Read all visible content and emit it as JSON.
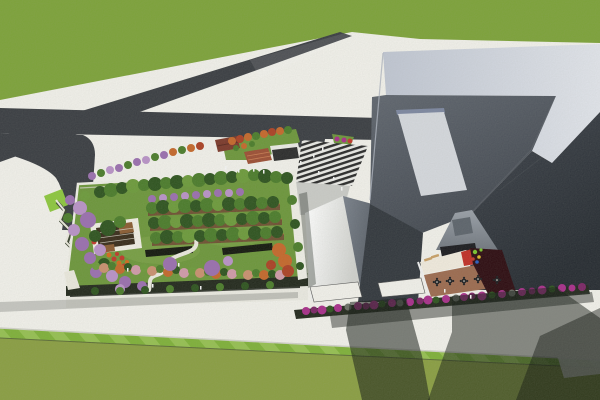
{
  "scene": {
    "type": "3d-architectural-aerial-render",
    "description": "Aerial 3D render: low building with rooftop garden at left, large angular grey building with inner courtyard at right, crossing asphalt roads over white pavement, green lawns top and bottom",
    "palette": {
      "grassTop": "#7da23a",
      "lawnMain": "#8a9e43",
      "lawnA": "#7fb03a",
      "lawnB": "#95bf52",
      "lawnEdge": "#5c6c38",
      "curb": "#d0d0c8",
      "pave": "#f0efe9",
      "road": "#3b3e43",
      "roadGlare": "rgba(255,255,255,0.10)",
      "lime": "#8dc63f",
      "parapetL": "#bfc5d1",
      "parapetR": "#e0e3e9",
      "roofLa": "#60666f",
      "roofLb": "#42474f",
      "roofRa": "#40454d",
      "roofRb": "#272c32",
      "facadeDark": "#33383e",
      "edgeHi": "#aeb4bf",
      "skylight": "#d4d7dc",
      "coping": "#7d87a0",
      "innerWallA": "#9aa0a8",
      "innerWallB": "#70767e",
      "ctVent": "#5d646c",
      "ctShade": "#1c1c20",
      "ctWhite": "#efe9dc",
      "ctBrown": "#9c6b50",
      "ctRed": "#c03028",
      "ctMaroon": "#2e0d12",
      "lounger": "#c8a068",
      "tableDark": "#1f2023",
      "brightA": "#ffffff",
      "brightB": "#cfd0cc",
      "grayWallA": "#7a818b",
      "grayWallB": "#4e545c",
      "ramp": "#c9cac6",
      "stripeDark": "#2a2a2a",
      "stripeLight": "#e8e8e4",
      "canopyWhite": "#f0efe9",
      "canopyEdge": "#555555",
      "kioskRed": "#7c3a2c",
      "kioskRidge": "#5c2a20",
      "shelterDark": "#2d2d2d",
      "shelterFascia": "#e9e9e3",
      "stepsTerra": "#9c4f35",
      "stepsLine": "#c77b52",
      "gardenLawn": "#6d963c",
      "gardenLawnLight": "#7ea44a",
      "facadeWhite": "#e9e8e0",
      "windowSlit": "#383c34",
      "hedge": "#242a1e",
      "hedgeDark": "#15190f",
      "planter": "#6f5233",
      "planterEdge": "#b5763c",
      "pergFrame": "#efece2",
      "pergDeck": "#3a2d1c",
      "pergWood": "#8a5c33",
      "path": "#e9e7dc",
      "pathWall": "#39422f",
      "gardenParapet": "#edece4",
      "tG": "#4c7c2c",
      "tGd": "#2f5420",
      "tGl": "#6d9a3c",
      "tO": "#c4682c",
      "tR": "#ab4226",
      "tP": "#9a6fae",
      "tPl": "#b892c6",
      "tPk": "#cf9aa8",
      "tS": "#c89070",
      "fR": "#c0392b",
      "fO": "#d2691e",
      "fM": "#a8308a",
      "fMd": "#7c2766",
      "fGr": "#6b6f66",
      "people": "#f4f4f4",
      "shLight": "rgba(40,45,40,0.22)",
      "shMid": "rgba(22,27,22,0.50)",
      "shCol": "rgba(22,27,22,0.55)",
      "shDeep": "rgba(14,18,14,0.45)",
      "shWalk": "rgba(45,50,45,0.50)",
      "shSliver": "rgba(25,35,25,0.35)"
    },
    "plaza_trees": [
      [
        92,
        176,
        4,
        "tP"
      ],
      [
        101,
        173,
        4,
        "tG"
      ],
      [
        110,
        170,
        4,
        "tPl"
      ],
      [
        119,
        168,
        4,
        "tP"
      ],
      [
        128,
        165,
        4,
        "tG"
      ],
      [
        137,
        162,
        4,
        "tP"
      ],
      [
        146,
        160,
        4,
        "tPl"
      ],
      [
        155,
        157,
        4,
        "tG"
      ],
      [
        164,
        155,
        4,
        "tP"
      ],
      [
        173,
        152,
        4,
        "tO"
      ],
      [
        182,
        150,
        4,
        "tG"
      ],
      [
        191,
        148,
        4,
        "tO"
      ],
      [
        200,
        146,
        4,
        "tR"
      ],
      [
        232,
        141,
        4,
        "tO"
      ],
      [
        240,
        139,
        4,
        "tR"
      ],
      [
        248,
        137,
        4,
        "tO"
      ],
      [
        256,
        136,
        4,
        "tG"
      ],
      [
        264,
        134,
        4,
        "tO"
      ],
      [
        272,
        132,
        4,
        "tR"
      ],
      [
        280,
        131,
        4,
        "tO"
      ],
      [
        288,
        130,
        4,
        "tG"
      ],
      [
        236,
        148,
        3,
        "tG"
      ],
      [
        244,
        146,
        3,
        "tO"
      ],
      [
        252,
        144,
        3,
        "tG"
      ],
      [
        337,
        139,
        2.5,
        "fM"
      ],
      [
        344,
        140,
        2.5,
        "fM"
      ],
      [
        350,
        141,
        2.5,
        "fR"
      ]
    ],
    "garden_trees": [
      [
        100,
        192,
        6,
        "tGd"
      ],
      [
        111,
        190,
        7,
        "tG"
      ],
      [
        122,
        188,
        6,
        "tGd"
      ],
      [
        133,
        186,
        7,
        "tGl"
      ],
      [
        144,
        185,
        6,
        "tG"
      ],
      [
        155,
        184,
        7,
        "tGd"
      ],
      [
        166,
        183,
        6,
        "tG"
      ],
      [
        177,
        182,
        7,
        "tGd"
      ],
      [
        188,
        181,
        6,
        "tGl"
      ],
      [
        199,
        180,
        7,
        "tG"
      ],
      [
        210,
        179,
        6,
        "tGd"
      ],
      [
        221,
        178,
        7,
        "tG"
      ],
      [
        232,
        177,
        6,
        "tGd"
      ],
      [
        243,
        176,
        7,
        "tGl"
      ],
      [
        254,
        175,
        6,
        "tG"
      ],
      [
        265,
        176,
        7,
        "tGd"
      ],
      [
        276,
        177,
        6,
        "tG"
      ],
      [
        287,
        178,
        6,
        "tGd"
      ],
      [
        152,
        199,
        4,
        "tP"
      ],
      [
        163,
        198,
        4,
        "tPl"
      ],
      [
        174,
        197,
        4,
        "tP"
      ],
      [
        185,
        196,
        4,
        "tPl"
      ],
      [
        196,
        195,
        4,
        "tP"
      ],
      [
        207,
        194,
        4,
        "tPl"
      ],
      [
        218,
        193,
        4,
        "tP"
      ],
      [
        229,
        193,
        4,
        "tPl"
      ],
      [
        240,
        192,
        4,
        "tP"
      ],
      [
        70,
        200,
        5,
        "tP"
      ],
      [
        80,
        208,
        7,
        "tPl"
      ],
      [
        68,
        218,
        5,
        "tG"
      ],
      [
        88,
        220,
        8,
        "tP"
      ],
      [
        74,
        230,
        6,
        "tPl"
      ],
      [
        95,
        236,
        6,
        "tGd"
      ],
      [
        82,
        244,
        7,
        "tP"
      ],
      [
        100,
        250,
        6,
        "tPl"
      ],
      [
        90,
        258,
        6,
        "tP"
      ],
      [
        104,
        264,
        6,
        "tGd"
      ],
      [
        96,
        272,
        6,
        "tP"
      ],
      [
        112,
        276,
        6,
        "tPl"
      ],
      [
        125,
        282,
        6,
        "tP"
      ],
      [
        85,
        196,
        5,
        "tGl"
      ],
      [
        108,
        228,
        8,
        "tGd"
      ],
      [
        120,
        222,
        6,
        "tG"
      ],
      [
        152,
        208,
        6,
        "tG"
      ],
      [
        163,
        207,
        7,
        "tGd"
      ],
      [
        174,
        207,
        6,
        "tGl"
      ],
      [
        185,
        206,
        7,
        "tG"
      ],
      [
        196,
        206,
        6,
        "tGd"
      ],
      [
        207,
        205,
        7,
        "tG"
      ],
      [
        218,
        205,
        6,
        "tGl"
      ],
      [
        229,
        204,
        7,
        "tGd"
      ],
      [
        240,
        204,
        6,
        "tG"
      ],
      [
        251,
        203,
        7,
        "tGd"
      ],
      [
        262,
        203,
        6,
        "tG"
      ],
      [
        273,
        202,
        6,
        "tGd"
      ],
      [
        154,
        223,
        6,
        "tGd"
      ],
      [
        165,
        222,
        7,
        "tG"
      ],
      [
        176,
        222,
        6,
        "tGl"
      ],
      [
        187,
        221,
        7,
        "tGd"
      ],
      [
        198,
        221,
        6,
        "tG"
      ],
      [
        209,
        220,
        7,
        "tGd"
      ],
      [
        220,
        220,
        6,
        "tG"
      ],
      [
        231,
        219,
        7,
        "tGl"
      ],
      [
        242,
        219,
        6,
        "tGd"
      ],
      [
        253,
        218,
        7,
        "tG"
      ],
      [
        264,
        218,
        6,
        "tGd"
      ],
      [
        275,
        217,
        6,
        "tG"
      ],
      [
        156,
        238,
        6,
        "tG"
      ],
      [
        167,
        237,
        7,
        "tGd"
      ],
      [
        178,
        237,
        6,
        "tG"
      ],
      [
        189,
        236,
        7,
        "tGl"
      ],
      [
        200,
        236,
        6,
        "tGd"
      ],
      [
        211,
        235,
        7,
        "tG"
      ],
      [
        222,
        235,
        6,
        "tGd"
      ],
      [
        233,
        234,
        7,
        "tG"
      ],
      [
        244,
        234,
        6,
        "tGl"
      ],
      [
        255,
        233,
        7,
        "tGd"
      ],
      [
        266,
        233,
        6,
        "tG"
      ],
      [
        277,
        232,
        6,
        "tGd"
      ],
      [
        96,
        266,
        4,
        "tGl"
      ],
      [
        104,
        268,
        5,
        "tS"
      ],
      [
        112,
        266,
        4,
        "tG"
      ],
      [
        120,
        269,
        5,
        "tO"
      ],
      [
        128,
        267,
        4,
        "tGd"
      ],
      [
        136,
        270,
        5,
        "tPk"
      ],
      [
        144,
        268,
        4,
        "tGl"
      ],
      [
        152,
        271,
        5,
        "tS"
      ],
      [
        160,
        269,
        4,
        "tG"
      ],
      [
        168,
        272,
        5,
        "tO"
      ],
      [
        176,
        270,
        4,
        "tGd"
      ],
      [
        184,
        273,
        5,
        "tPk"
      ],
      [
        192,
        271,
        4,
        "tGl"
      ],
      [
        200,
        273,
        5,
        "tS"
      ],
      [
        208,
        272,
        4,
        "tG"
      ],
      [
        216,
        274,
        5,
        "tO"
      ],
      [
        224,
        272,
        4,
        "tGd"
      ],
      [
        232,
        274,
        5,
        "tPk"
      ],
      [
        240,
        273,
        4,
        "tGl"
      ],
      [
        248,
        275,
        5,
        "tS"
      ],
      [
        256,
        273,
        4,
        "tG"
      ],
      [
        264,
        275,
        5,
        "tO"
      ],
      [
        272,
        274,
        4,
        "tGd"
      ],
      [
        280,
        275,
        5,
        "tPk"
      ],
      [
        279,
        250,
        7,
        "tO"
      ],
      [
        285,
        261,
        7,
        "tO"
      ],
      [
        288,
        271,
        6,
        "tR"
      ],
      [
        271,
        265,
        5,
        "tR"
      ],
      [
        170,
        264,
        7,
        "tP"
      ],
      [
        212,
        268,
        8,
        "tP"
      ],
      [
        228,
        261,
        5,
        "tPl"
      ],
      [
        142,
        286,
        5,
        "tP"
      ],
      [
        120,
        289,
        5,
        "tPl"
      ],
      [
        292,
        200,
        5,
        "tG"
      ],
      [
        295,
        224,
        5,
        "tGd"
      ],
      [
        298,
        247,
        5,
        "tG"
      ],
      [
        300,
        266,
        4,
        "tGd"
      ],
      [
        95,
        291,
        4,
        "tGd"
      ],
      [
        120,
        291,
        4,
        "tG"
      ],
      [
        145,
        290,
        4,
        "tGd"
      ],
      [
        170,
        289,
        4,
        "tG"
      ],
      [
        195,
        288,
        4,
        "tGd"
      ],
      [
        220,
        287,
        4,
        "tG"
      ],
      [
        245,
        286,
        4,
        "tGd"
      ],
      [
        270,
        285,
        4,
        "tG"
      ]
    ],
    "garden_flowers": [
      [
        94,
        242,
        2.5,
        "fR"
      ],
      [
        99,
        247,
        2.5,
        "fO"
      ],
      [
        104,
        251,
        2.5,
        "fR"
      ],
      [
        109,
        255,
        2.5,
        "fO"
      ],
      [
        114,
        259,
        2.5,
        "fR"
      ],
      [
        119,
        263,
        2.5,
        "fO"
      ],
      [
        124,
        266,
        2.5,
        "fR"
      ],
      [
        129,
        269,
        2.5,
        "fO"
      ],
      [
        134,
        271,
        2.5,
        "fR"
      ],
      [
        122,
        258,
        2.5,
        "fR"
      ],
      [
        127,
        262,
        2,
        "fO"
      ],
      [
        117,
        254,
        2,
        "fR"
      ]
    ],
    "hedge_flowers": [
      [
        306,
        311,
        4,
        "fM"
      ],
      [
        314,
        310,
        3.5,
        "fMd"
      ],
      [
        322,
        310,
        4.5,
        "fM"
      ],
      [
        330,
        309,
        3.5,
        "tGd"
      ],
      [
        338,
        308,
        4,
        "fM"
      ],
      [
        348,
        307,
        3.5,
        "fGr"
      ],
      [
        358,
        306,
        4,
        "fM"
      ],
      [
        366,
        306,
        3.5,
        "fMd"
      ],
      [
        374,
        305,
        4.5,
        "fM"
      ],
      [
        382,
        304,
        3.5,
        "tGd"
      ],
      [
        392,
        303,
        4,
        "fM"
      ],
      [
        400,
        303,
        3.5,
        "fGr"
      ],
      [
        410,
        302,
        4,
        "fM"
      ],
      [
        420,
        301,
        3.5,
        "fMd"
      ],
      [
        428,
        300,
        4.5,
        "fM"
      ],
      [
        436,
        300,
        3.5,
        "tGd"
      ],
      [
        446,
        299,
        4,
        "fM"
      ],
      [
        456,
        298,
        3.5,
        "fGr"
      ],
      [
        464,
        297,
        4,
        "fM"
      ],
      [
        472,
        296,
        3.5,
        "fMd"
      ],
      [
        482,
        296,
        4.5,
        "fM"
      ],
      [
        492,
        295,
        3.5,
        "tGd"
      ],
      [
        502,
        294,
        4,
        "fM"
      ],
      [
        512,
        293,
        3.5,
        "fGr"
      ],
      [
        522,
        292,
        4,
        "fM"
      ],
      [
        532,
        291,
        3.5,
        "fMd"
      ],
      [
        542,
        290,
        4.5,
        "fM"
      ],
      [
        552,
        289,
        3.5,
        "tGd"
      ],
      [
        562,
        288,
        4,
        "fM"
      ],
      [
        572,
        288,
        3.5,
        "fM"
      ],
      [
        582,
        287,
        4,
        "fMd"
      ]
    ],
    "playground_bits": [
      [
        475,
        252,
        2.2,
        "#7ac32e"
      ],
      [
        479,
        257,
        1.8,
        "#d8b62a"
      ],
      [
        473,
        259,
        1.8,
        "#c03a2a"
      ],
      [
        477,
        262,
        1.8,
        "#2a5fc0"
      ],
      [
        481,
        250,
        1.6,
        "#7ac32e"
      ]
    ],
    "people": [
      [
        225,
        166
      ],
      [
        238,
        169
      ],
      [
        253,
        168
      ],
      [
        263,
        170
      ],
      [
        300,
        161
      ],
      [
        313,
        154
      ],
      [
        322,
        147
      ],
      [
        318,
        171
      ],
      [
        333,
        177
      ],
      [
        341,
        187
      ],
      [
        178,
        263
      ],
      [
        200,
        286
      ],
      [
        152,
        284
      ],
      [
        127,
        268
      ],
      [
        444,
        289
      ],
      [
        470,
        295
      ]
    ],
    "courtyard": {
      "tables": [
        [
          437,
          282
        ],
        [
          450,
          281
        ],
        [
          464,
          281
        ],
        [
          478,
          279
        ],
        [
          497,
          280
        ]
      ]
    }
  }
}
